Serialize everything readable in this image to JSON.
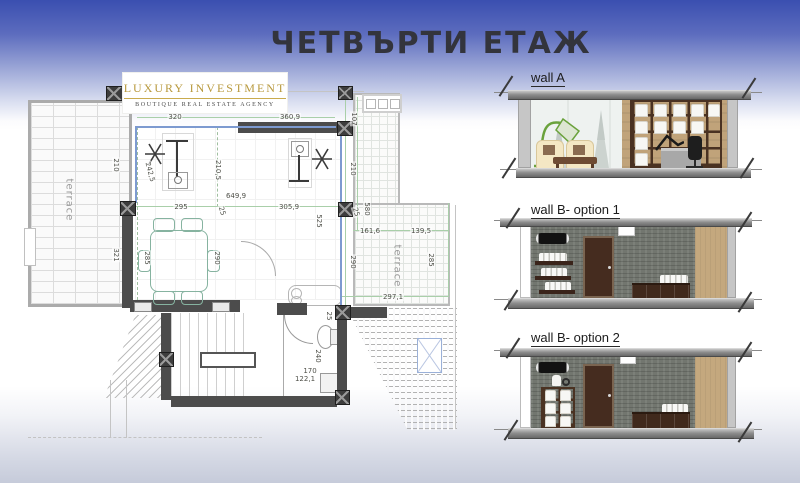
{
  "title": "ЧЕТВЪРТИ ЕТАЖ",
  "logo": {
    "name": "LUXURY INVESTMENT",
    "tagline": "BOUTIQUE REAL ESTATE AGENCY"
  },
  "floor_plan": {
    "terrace_left_label": "terrace",
    "terrace_right_label": "terrace",
    "dims": {
      "d01": "320",
      "d02": "360,9",
      "d03": "107",
      "d04": "210",
      "d05": "242,5",
      "d06": "210,5",
      "d07": "649,9",
      "d08": "295",
      "d09": "25",
      "d10": "305,9",
      "d11": "525",
      "d12": "210",
      "d13": "580",
      "d14": "25",
      "d15": "161,6",
      "d16": "139,5",
      "d17": "321",
      "d18": "285",
      "d19": "290",
      "d20": "290",
      "d21": "285",
      "d22": "297,1",
      "d23": "25",
      "d24": "240",
      "d25": "170",
      "d26": "122,1"
    }
  },
  "elevations": [
    {
      "label": "wall A"
    },
    {
      "label": "wall B- option 1"
    },
    {
      "label": "wall B- option 2"
    }
  ],
  "colors": {
    "header_blue": "#3a4fb0",
    "logo_gold": "#b8993d",
    "wall_dark": "#4c4c4c",
    "glass_blue": "#7d9ad0",
    "dim_green": "#a9cfa9",
    "furniture_teal": "#86b3a0",
    "slab_gray": "#8e8e8e",
    "stone_gray": "#72766f",
    "wood_tan": "#c4a87e",
    "door_brown": "#452c1f",
    "shelf_brown": "#4a3222",
    "lamp_green": "#6aa23c",
    "chair_cream": "#f4e7c4"
  }
}
